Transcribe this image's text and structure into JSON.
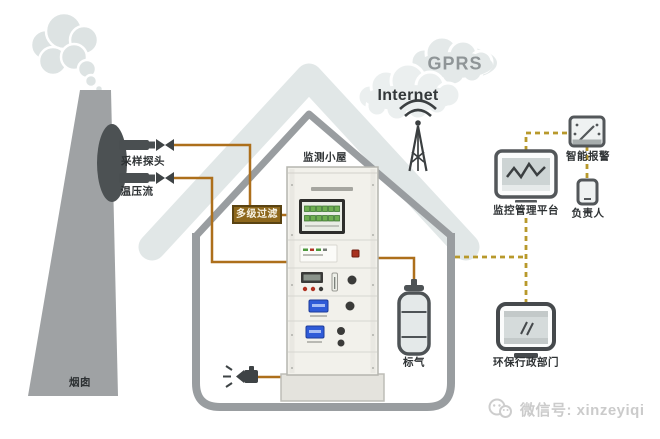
{
  "labels": {
    "chimney": "烟囱",
    "probe": "采样探头",
    "temp_pressure_flow": "温压流",
    "filter": "多级过滤",
    "monitor_cabin": "监测小屋",
    "standard_gas": "标气",
    "gprs": "GPRS",
    "internet": "Internet",
    "platform": "监控管理平台",
    "smart_alarm": "智能报警",
    "person_in_charge": "负责人",
    "epa_department": "环保行政部门"
  },
  "watermark": {
    "text": "微信号: xinzeyiqi"
  },
  "colors": {
    "pipe_line": "#ad6f1b",
    "dashed_link": "#b8992b",
    "filter_box_bg": "#8d671c",
    "house_outline": "#999da0",
    "roof_fill": "#e1e7e7",
    "chimney_fill": "#9fa2a4",
    "icon_stroke": "#53575a",
    "lcd_blue": "#2f5bd8",
    "button_green": "#6fae52",
    "indicator_red": "#b03020"
  },
  "icons": {
    "smoke-icon": "smoke-puffs",
    "probe-icon": "sampling-probe-with-valve",
    "antenna-icon": "radio-tower-with-waves",
    "cloud-icon": "network-cloud",
    "gas-cylinder-icon": "calibration-gas-cylinder",
    "exhaust-nozzle-icon": "exhaust-nozzle",
    "platform-monitor-icon": "monitor-with-trend-line",
    "smart-alarm-icon": "gauge-alarm-panel",
    "phone-icon": "smartphone",
    "epa-monitor-icon": "desktop-computer",
    "wechat-icon": "wechat-bubbles"
  }
}
